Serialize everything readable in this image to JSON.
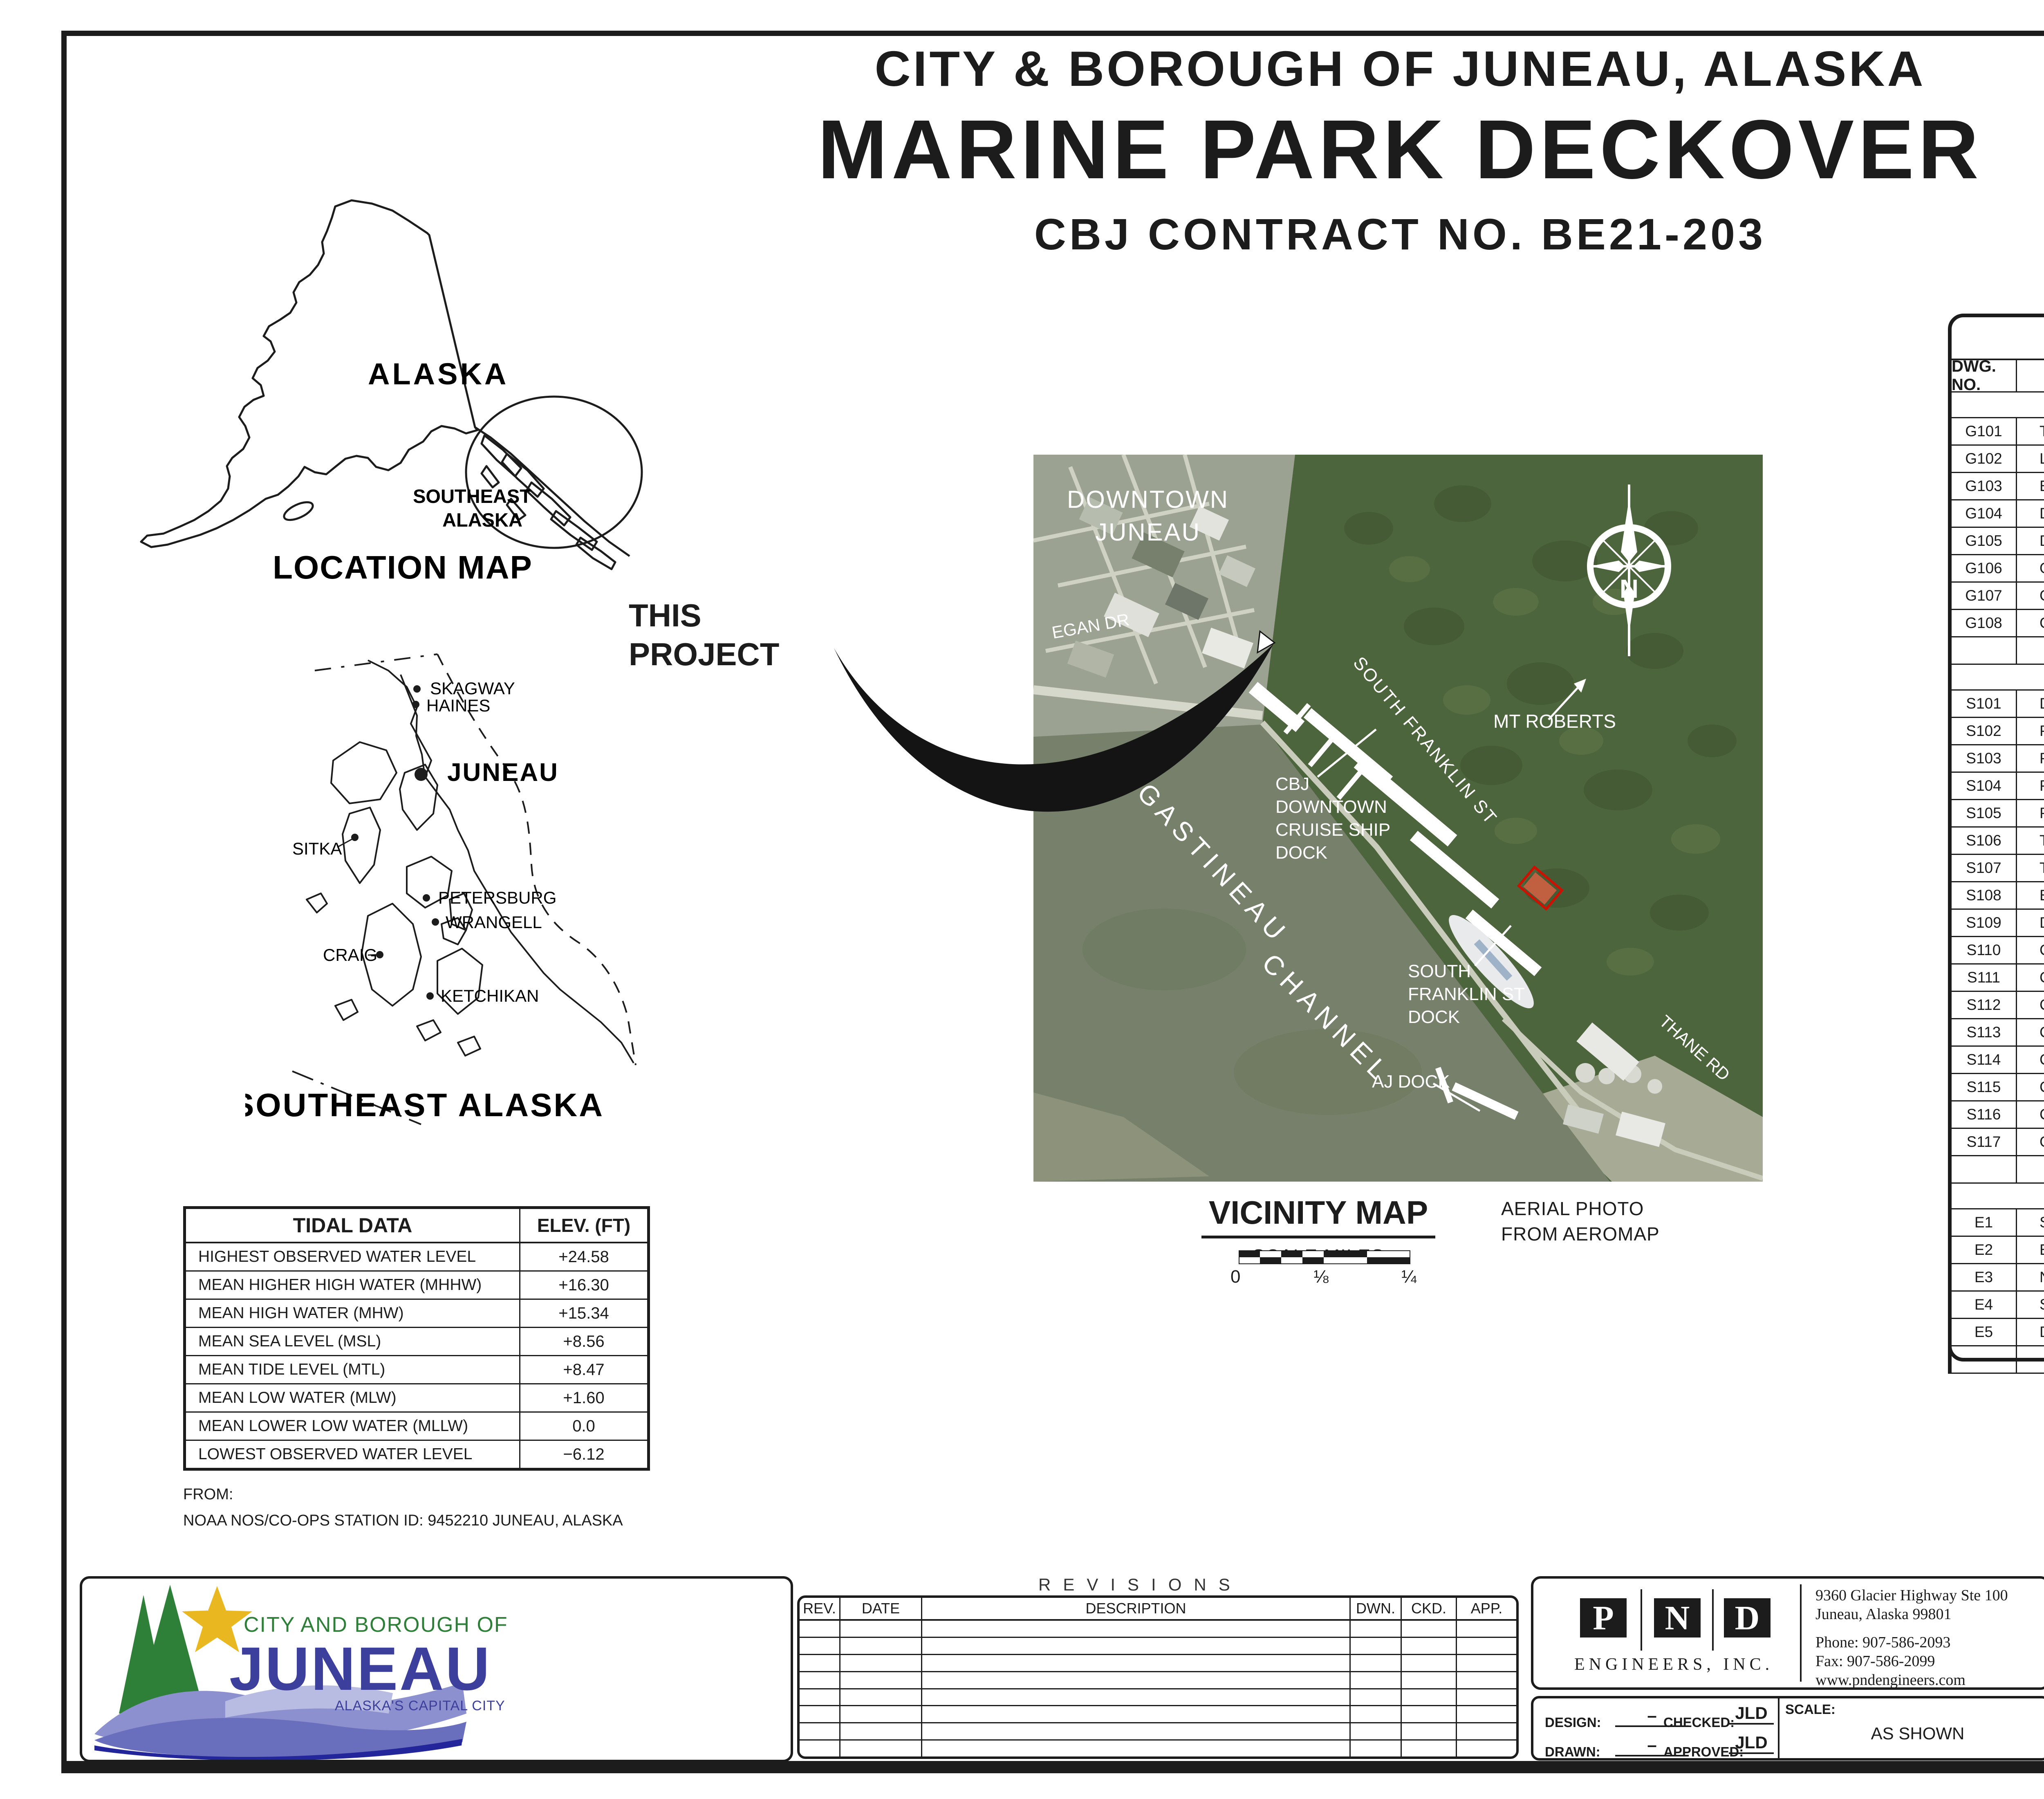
{
  "header": {
    "line1": "CITY & BOROUGH OF JUNEAU, ALASKA",
    "line2": "MARINE PARK DECKOVER",
    "line3": "CBJ CONTRACT NO. BE21-203"
  },
  "location_map": {
    "alaska": "ALASKA",
    "southeast1": "SOUTHEAST",
    "southeast2": "ALASKA",
    "title": "LOCATION MAP"
  },
  "se_map": {
    "title": "SOUTHEAST ALASKA",
    "cities": [
      {
        "name": "SKAGWAY"
      },
      {
        "name": "HAINES"
      },
      {
        "name": "JUNEAU"
      },
      {
        "name": "SITKA"
      },
      {
        "name": "PETERSBURG"
      },
      {
        "name": "WRANGELL"
      },
      {
        "name": "CRAIG"
      },
      {
        "name": "KETCHIKAN"
      }
    ]
  },
  "project_callout": {
    "line1": "THIS",
    "line2": "PROJECT"
  },
  "vicinity": {
    "downtown1": "DOWNTOWN",
    "downtown2": "JUNEAU",
    "egan": "EGAN DR",
    "mt_roberts": "MT ROBERTS",
    "gastineau": "GASTINEAU",
    "channel": "CHANNEL",
    "s_franklin_st": "SOUTH FRANKLIN ST",
    "cruise_dock": [
      "CBJ",
      "DOWNTOWN",
      "CRUISE SHIP",
      "DOCK"
    ],
    "sf_dock": [
      "SOUTH",
      "FRANKLIN ST",
      "DOCK"
    ],
    "aj_dock": "AJ DOCK",
    "thane": "THANE RD",
    "compass_n": "N",
    "title": "VICINITY MAP",
    "scale_title": "SCALE MILES",
    "scale_ticks": [
      "0",
      "⅛",
      "¼"
    ],
    "credit1": "AERIAL PHOTO",
    "credit2": "FROM AEROMAP"
  },
  "tidal": {
    "title": "TIDAL DATA",
    "col": "ELEV. (FT)",
    "rows": [
      [
        "HIGHEST OBSERVED WATER LEVEL",
        "+24.58"
      ],
      [
        "MEAN HIGHER HIGH WATER (MHHW)",
        "+16.30"
      ],
      [
        "MEAN HIGH WATER (MHW)",
        "+15.34"
      ],
      [
        "MEAN SEA LEVEL (MSL)",
        "+8.56"
      ],
      [
        "MEAN TIDE LEVEL (MTL)",
        "+8.47"
      ],
      [
        "MEAN LOW WATER (MLW)",
        "+1.60"
      ],
      [
        "MEAN LOWER LOW WATER (MLLW)",
        "0.0"
      ],
      [
        "LOWEST OBSERVED WATER LEVEL",
        "−6.12"
      ]
    ],
    "from_label": "FROM:",
    "from_note": "NOAA NOS/CO-OPS STATION ID: 9452210 JUNEAU, ALASKA"
  },
  "drawing_index": {
    "title": "DRAWING INDEX",
    "col_no": "DWG. NO.",
    "col_title": "TITLE",
    "sections": [
      {
        "name": "GENERAL",
        "rows": [
          [
            "G101",
            "TITLE SHEET, VICINITY MAP AND DRAWING INDEX"
          ],
          [
            "G102",
            "LEGEND, ABBREVIATIONS AND GENERAL NOTES"
          ],
          [
            "G103",
            "EXISTING CONDITIONS AND SURVEY CONTROL"
          ],
          [
            "G104",
            "DEMOLITION PLAN"
          ],
          [
            "G105",
            "DEMOLITION DETAILS"
          ],
          [
            "G106",
            "OVERALL SITE PLAN WITH GRADING"
          ],
          [
            "G107",
            "GENERAL SECTIONS"
          ],
          [
            "G108",
            "GENERAL SECTIONS"
          ]
        ]
      },
      {
        "name": "STRUCTURAL",
        "rows": [
          [
            "S101",
            "DECK AND FRAMING PLAN"
          ],
          [
            "S102",
            "PILE PLAN AND SCHEDULE"
          ],
          [
            "S103",
            "PILE DETAILS"
          ],
          [
            "S104",
            "PILE CAP DETAILS"
          ],
          [
            "S105",
            "PILE CAP DETAILS"
          ],
          [
            "S106",
            "TIMBER DOCK SECTION AND DETAILS"
          ],
          [
            "S107",
            "TIMBER DOCK TRANSITION TO EXISTING DOCK"
          ],
          [
            "S108",
            "EXISTING MOORING DOLPHIN MODIFICATIONS"
          ],
          [
            "S109",
            "DOCK CONNECTION DETAILS"
          ],
          [
            "S110",
            "CONCRETE WALL DETAILS"
          ],
          [
            "S111",
            "CONCRETE DECK PANEL DETAILS"
          ],
          [
            "S112",
            "CONCRETE DECK PANEL DETAILS"
          ],
          [
            "S113",
            "CABLE STRAND RAILING ELEVATION"
          ],
          [
            "S114",
            "CABLE STRAND RAILING DETAILS"
          ],
          [
            "S115",
            "CABLE STRAND RAILING DETAILS"
          ],
          [
            "S116",
            "CABLE STRAND RAILING DETAILS"
          ],
          [
            "S117",
            "GRADING AND DRAINAGE DETAILS"
          ]
        ]
      },
      {
        "name": "ELECTRICAL",
        "rows": [
          [
            "E1",
            "SITE PLAN – NORTH BERTH"
          ],
          [
            "E2",
            "EXISTING SITE PLAN ELECTRICAL"
          ],
          [
            "E3",
            "NEW SITE PLAN ELECTRICAL"
          ],
          [
            "E4",
            "SINGLE LINE DIAGRAM – NORTH BERTH DISTRIBUTION"
          ],
          [
            "E5",
            "DETAILS"
          ]
        ]
      }
    ]
  },
  "revisions": {
    "title": "REVISIONS",
    "cols": [
      "REV.",
      "DATE",
      "DESCRIPTION",
      "DWN.",
      "CKD.",
      "APP."
    ],
    "empty_rows": 8
  },
  "logo": {
    "line1": "CITY AND BOROUGH OF",
    "line2": "JUNEAU",
    "line3": "ALASKA'S CAPITAL CITY",
    "green": "#2e8038",
    "blue": "#3c3f9c",
    "star": "#e9b821",
    "wave1": "#8d90cf",
    "wave2": "#6a6fbd",
    "wave3": "#b9bce2",
    "wave4": "#23269b"
  },
  "pnd": {
    "letters": [
      "P",
      "N",
      "D"
    ],
    "name": "ENGINEERS, INC.",
    "address1": "9360 Glacier Highway Ste 100",
    "address2": "Juneau, Alaska 99801",
    "phone": "Phone: 907-586-2093",
    "fax": "Fax: 907-586-2099",
    "web": "www.pndengineers.com"
  },
  "fields": {
    "design_label": "DESIGN:",
    "design": "–",
    "drawn_label": "DRAWN:",
    "drawn": "–",
    "checked_label": "CHECKED:",
    "checked": "JLD",
    "approved_label": "APPROVED:",
    "approved": "JLD",
    "scale_label": "SCALE:",
    "scale": "AS SHOWN"
  },
  "stamp": {
    "arc_top": "STATE OF ALASKA",
    "forty_nine": "49",
    "th": "TH",
    "name": "John L. DeMuth",
    "license": "SE-14159",
    "arc_bottom": "REGISTERED STRUCTURAL ENGINEER",
    "date_label": "DATE:",
    "date": "07/19/2021",
    "signature_color": "#2b3bc7"
  },
  "project_block": {
    "line1": "CITY & BOROUGH OF JUNEAU, ALASKA",
    "line2": "MARINE PARK DECKOVER",
    "line3": "CBJ CONTRACT NO. BE21-203",
    "sheet_title_label": "SHEET TITLE:",
    "sheet_title1": "TITLE SHEET, VICINITY MAP",
    "sheet_title2": "AND DRAWING INDEX",
    "pnd_no_label": "PND PROJECT NO.:",
    "pnd_no": "192091",
    "can_label": "C.A.N. NO.:",
    "can": "AECC250",
    "number": "G101"
  }
}
